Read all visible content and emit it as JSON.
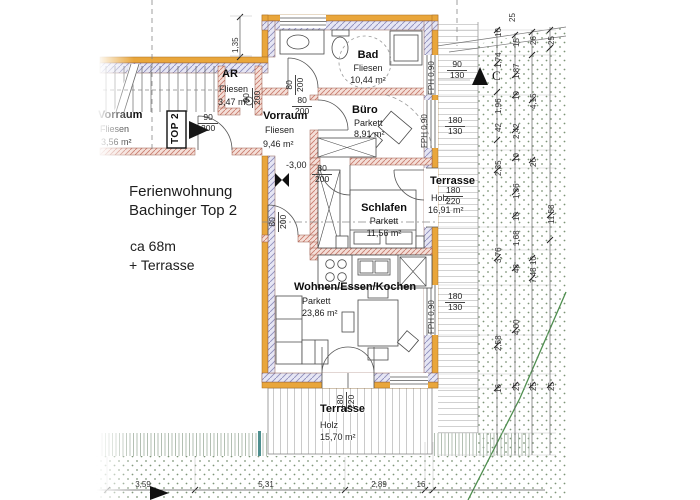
{
  "title": {
    "l1": "Ferienwohnung",
    "l2": "Bachinger Top 2",
    "l3": "ca 68m",
    "l4": "+ Terrasse"
  },
  "unit_tag": "TOP 2",
  "section_letter": "C",
  "level_marker": "-3,00",
  "rooms": {
    "ar": {
      "name": "AR",
      "floor": "Fliesen",
      "area": "3,47 m²"
    },
    "bad": {
      "name": "Bad",
      "floor": "Fliesen",
      "area": "10,44 m²"
    },
    "buero": {
      "name": "Büro",
      "floor": "Parkett",
      "area": "8,91 m²"
    },
    "vorraum": {
      "name": "Vorraum",
      "floor": "Fliesen",
      "area": "9,46 m²"
    },
    "vorraum_links": {
      "name": "Vorraum",
      "floor": "Fliesen",
      "area": "3,56 m²"
    },
    "schlafen": {
      "name": "Schlafen",
      "floor": "Parkett",
      "area": "11,56 m²"
    },
    "wohnen": {
      "name": "Wohnen/Essen/Kochen",
      "floor": "Parkett",
      "area": "23,86 m²"
    },
    "terrasse_rechts": {
      "name": "Terrasse",
      "floor": "Holz",
      "area": "16,91 m²"
    },
    "terrasse_unten": {
      "name": "Terrasse",
      "floor": "Holz",
      "area": "15,70 m²"
    }
  },
  "windows": {
    "fph": "FPH 0,90"
  },
  "size_labels": [
    {
      "a": "90",
      "b": "200",
      "x": 198,
      "y": 113,
      "rot": 0
    },
    {
      "a": "80",
      "b": "200",
      "x": 292,
      "y": 96,
      "rot": 0
    },
    {
      "a": "80",
      "b": "200",
      "x": 312,
      "y": 164,
      "rot": 0
    },
    {
      "a": "80",
      "b": "200",
      "x": 268,
      "y": 232,
      "rot": 1
    },
    {
      "a": "80",
      "b": "200",
      "x": 285,
      "y": 95,
      "rot": 1
    },
    {
      "a": "90",
      "b": "200",
      "x": 242,
      "y": 108,
      "rot": 1
    },
    {
      "a": "90",
      "b": "130",
      "x": 447,
      "y": 60,
      "rot": 0
    },
    {
      "a": "180",
      "b": "130",
      "x": 445,
      "y": 116,
      "rot": 0
    },
    {
      "a": "180",
      "b": "130",
      "x": 445,
      "y": 292,
      "rot": 0
    },
    {
      "a": "180",
      "b": "220",
      "x": 443,
      "y": 186,
      "rot": 0
    },
    {
      "a": "180",
      "b": "220",
      "x": 336,
      "y": 412,
      "rot": 1
    }
  ],
  "dims": {
    "wall_offset": "1,35",
    "right": [
      {
        "v": "25",
        "x": 508,
        "y": 22
      },
      {
        "v": "16",
        "x": 494,
        "y": 37
      },
      {
        "v": "1,74",
        "x": 494,
        "y": 68
      },
      {
        "v": "1,96",
        "x": 494,
        "y": 114
      },
      {
        "v": "42",
        "x": 494,
        "y": 132
      },
      {
        "v": "2,35",
        "x": 494,
        "y": 176
      },
      {
        "v": "3,76",
        "x": 494,
        "y": 263
      },
      {
        "v": "2,58",
        "x": 494,
        "y": 351
      },
      {
        "v": "16",
        "x": 494,
        "y": 393
      },
      {
        "v": "15",
        "x": 512,
        "y": 47
      },
      {
        "v": "1,87",
        "x": 512,
        "y": 79
      },
      {
        "v": "10",
        "x": 512,
        "y": 100
      },
      {
        "v": "2,42",
        "x": 512,
        "y": 139
      },
      {
        "v": "10",
        "x": 512,
        "y": 162
      },
      {
        "v": "1,36",
        "x": 512,
        "y": 199
      },
      {
        "v": "10",
        "x": 512,
        "y": 221
      },
      {
        "v": "1,68",
        "x": 512,
        "y": 246
      },
      {
        "v": "48",
        "x": 512,
        "y": 273
      },
      {
        "v": "4,00",
        "x": 512,
        "y": 335
      },
      {
        "v": "25",
        "x": 512,
        "y": 391
      },
      {
        "v": "26",
        "x": 529,
        "y": 45
      },
      {
        "v": "4,15",
        "x": 529,
        "y": 109
      },
      {
        "v": "26",
        "x": 529,
        "y": 167
      },
      {
        "v": "10",
        "x": 529,
        "y": 265
      },
      {
        "v": "7,48",
        "x": 529,
        "y": 283
      },
      {
        "v": "25",
        "x": 529,
        "y": 391
      },
      {
        "v": "25",
        "x": 547,
        "y": 45
      },
      {
        "v": "11,58",
        "x": 547,
        "y": 224
      },
      {
        "v": "25",
        "x": 547,
        "y": 391
      }
    ],
    "bottom": [
      {
        "v": "3,59",
        "x": 143,
        "y": 480
      },
      {
        "v": "5,31",
        "x": 266,
        "y": 480
      },
      {
        "v": "2,89",
        "x": 379,
        "y": 480
      },
      {
        "v": "16",
        "x": 421,
        "y": 480
      }
    ]
  },
  "colors": {
    "wall_insulation": "#E9A63B",
    "exterior_hatch": "#8D8DBB",
    "interior_wall": "#C9796A",
    "ground_dot": "#7E9478",
    "boundary_line": "#4E8E4E",
    "post_teal": "#4E8F8F"
  }
}
